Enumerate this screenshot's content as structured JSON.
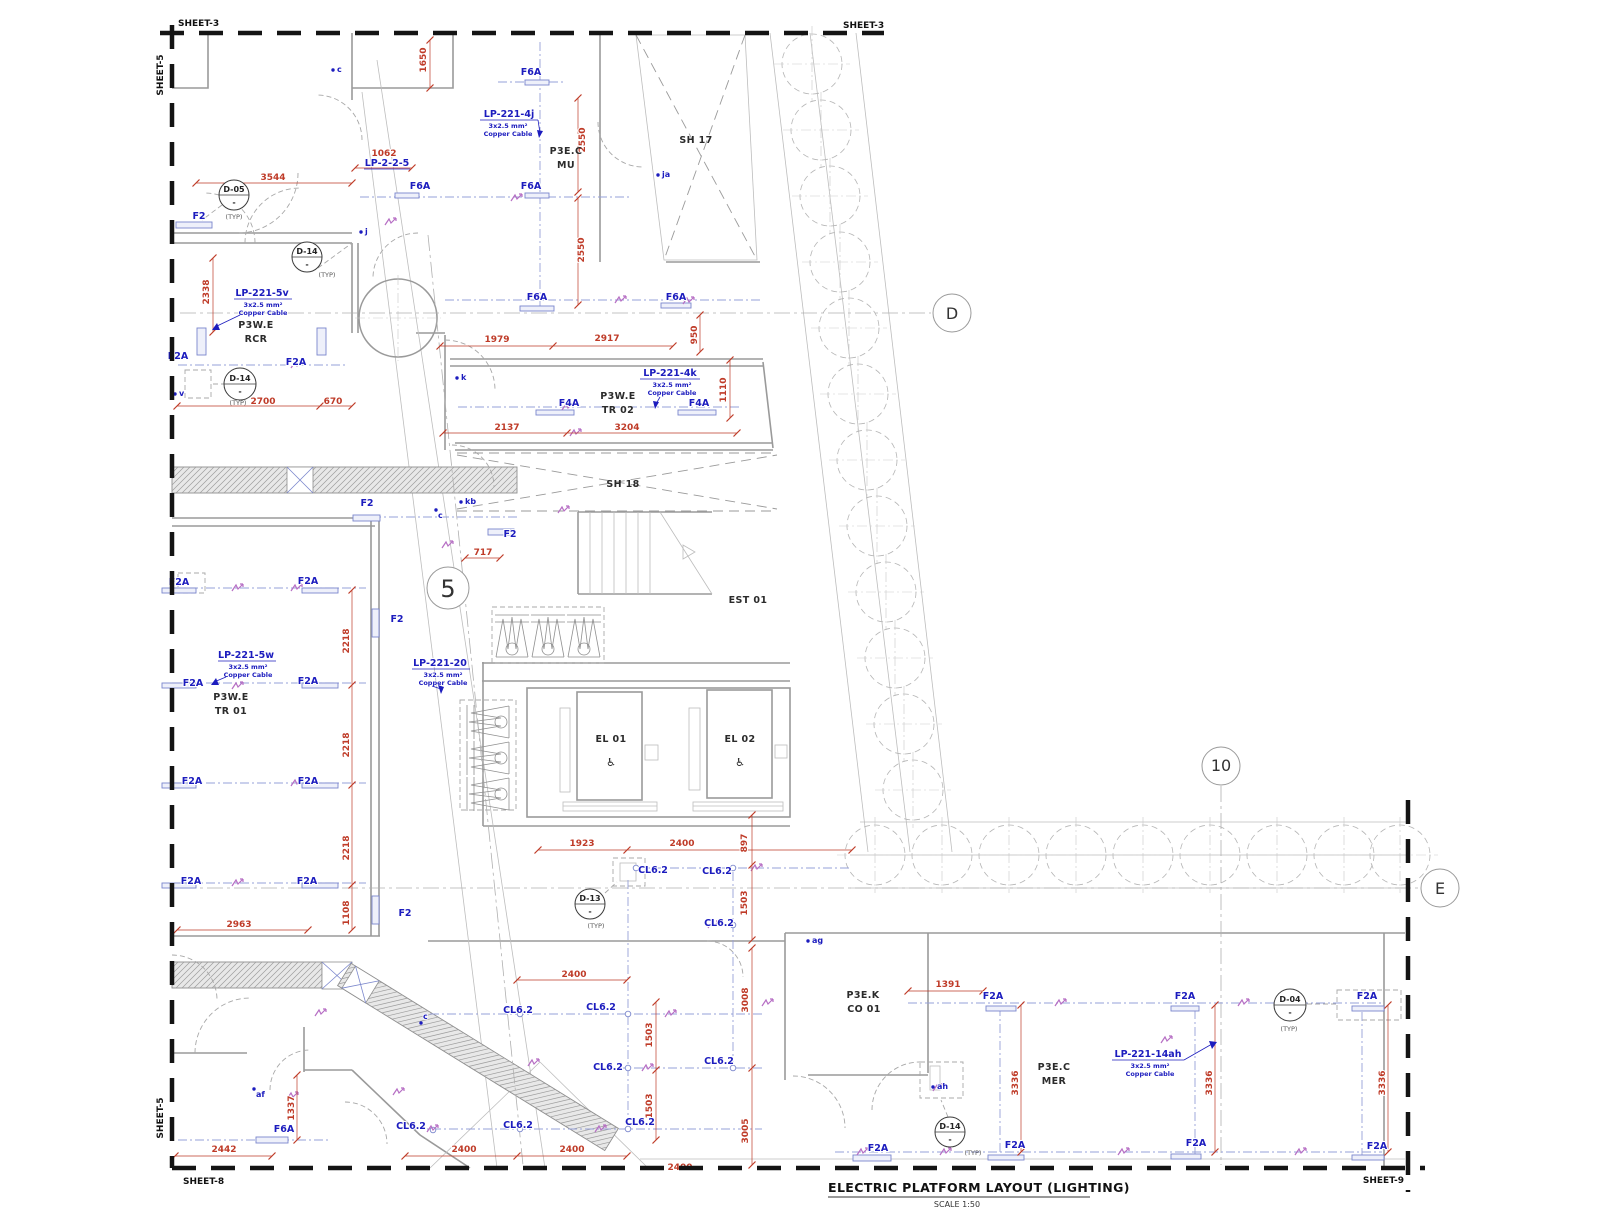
{
  "title": {
    "main": "ELECTRIC PLATFORM LAYOUT (LIGHTING)",
    "scale": "SCALE 1:50"
  },
  "sheets": {
    "top_left": "SHEET-3",
    "top_right": "SHEET-3",
    "left_top": "SHEET-5",
    "left_bottom": "SHEET-5",
    "bottom_left": "SHEET-8",
    "bottom_right": "SHEET-9"
  },
  "grid": {
    "d": "D",
    "e": "E",
    "n5": "5",
    "n10": "10"
  },
  "rooms": {
    "mu_sys": "P3E.C",
    "mu": "MU",
    "sh17": "SH 17",
    "rcr_sys": "P3W.E",
    "rcr": "RCR",
    "tr02_sys": "P3W.E",
    "tr02": "TR 02",
    "sh18": "SH 18",
    "est": "EST 01",
    "el01": "EL 01",
    "el02": "EL 02",
    "tr01_sys": "P3W.E",
    "tr01": "TR 01",
    "co_sys": "P3E.K",
    "co": "CO 01",
    "mer_sys": "P3E.C",
    "mer": "MER"
  },
  "icons": {
    "wheelchair": "♿"
  },
  "devices": {
    "d05": "D-05",
    "d14": "D-14",
    "d13": "D-13",
    "d04": "D-04",
    "sub": "-",
    "typ": "(TYP)"
  },
  "circuits": {
    "lp221_4j": {
      "tag": "LP-221-4j",
      "size": "3x2.5 mm²",
      "type": "Copper Cable"
    },
    "lp225": {
      "tag": "LP-2-2-5"
    },
    "lp221_5v": {
      "tag": "LP-221-5v",
      "size": "3x2.5 mm²",
      "type": "Copper Cable"
    },
    "lp221_4k": {
      "tag": "LP-221-4k",
      "size": "3x2.5 mm²",
      "type": "Copper Cable"
    },
    "lp221_5w": {
      "tag": "LP-221-5w",
      "size": "3x2.5 mm²",
      "type": "Copper Cable"
    },
    "lp221_20": {
      "tag": "LP-221-20",
      "size": "3x2.5 mm²",
      "type": "Copper Cable"
    },
    "lp221_14ah": {
      "tag": "LP-221-14ah",
      "size": "3x2.5 mm²",
      "type": "Copper Cable"
    }
  },
  "fx": {
    "f6a": "F6A",
    "f2": "F2",
    "f2a": "F2A",
    "f4a": "F4A",
    "cl62": "CL6.2"
  },
  "points": {
    "c": "c",
    "j": "j",
    "ja": "ja",
    "k": "k",
    "kb": "kb",
    "v": "v",
    "ag": "ag",
    "ah": "ah",
    "af": "af"
  },
  "dims": {
    "d3544": "3544",
    "d1062": "1062",
    "d1650": "1650",
    "d2550": "2550",
    "d2338": "2338",
    "d1979": "1979",
    "d2917": "2917",
    "d950": "950",
    "d1110": "1110",
    "d2700": "2700",
    "d670": "670",
    "d2137": "2137",
    "d3204": "3204",
    "d717": "717",
    "d2218": "2218",
    "d1108": "1108",
    "d2963": "2963",
    "d1923": "1923",
    "d2400": "2400",
    "d897": "897",
    "d1503": "1503",
    "d3008": "3008",
    "d3005": "3005",
    "d2442": "2442",
    "d1337": "1337",
    "d1391": "1391",
    "d3336": "3336"
  }
}
